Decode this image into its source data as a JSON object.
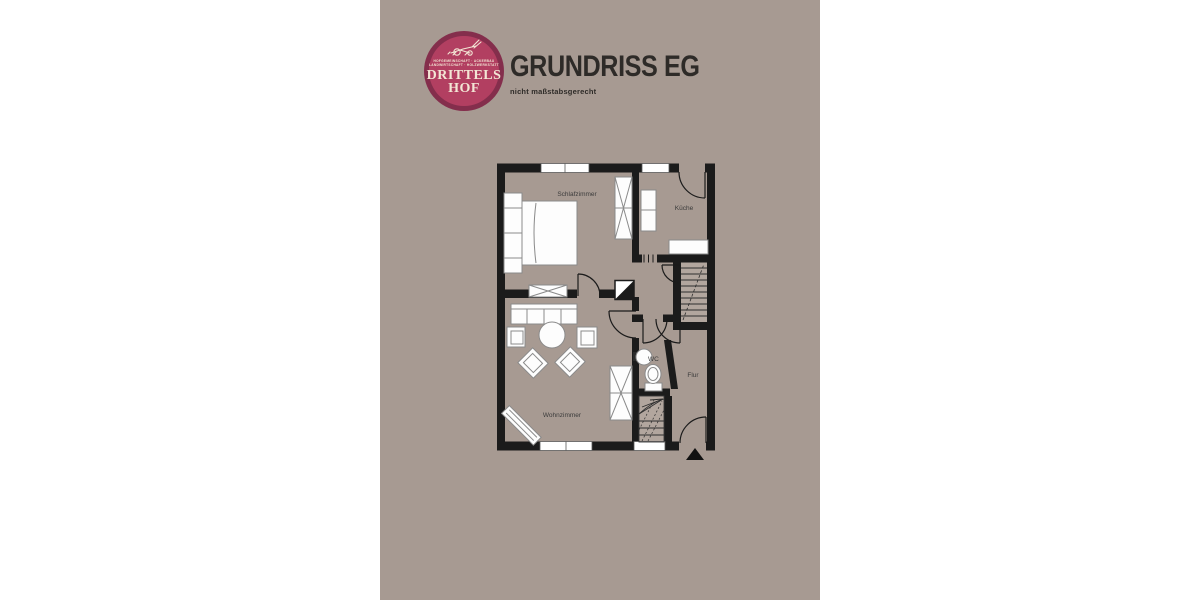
{
  "window": {
    "width": 1200,
    "height": 600
  },
  "colors": {
    "page_bg": "#ffffff",
    "panel_bg": "#a79a92",
    "wall": "#1b1b1b",
    "furniture_fill": "#fdfdfd",
    "furniture_stroke": "#8a8a8a",
    "stair_fill": "#b2a69e",
    "label": "#3b3b3b",
    "logo_ring": "#842e4c",
    "logo_face": "#b23f61",
    "logo_text": "#f3e6d5",
    "title": "#2e2b28"
  },
  "logo": {
    "title_line1": "DRITTELS",
    "title_line2": "HOF",
    "tagline_line1": "HOFGEMEINSCHAFT · ACKERBAU",
    "tagline_line2": "LANDWIRTSCHAFT · HOLZWERKSTATT",
    "illustration": "plow-illustration"
  },
  "header": {
    "title": "GRUNDRISS EG",
    "subtitle": "nicht maßstabsgerecht"
  },
  "floorplan": {
    "rooms": [
      {
        "id": "schlafzimmer",
        "label": "Schlafzimmer"
      },
      {
        "id": "kueche",
        "label": "Küche"
      },
      {
        "id": "wohnzimmer",
        "label": "Wohnzimmer"
      },
      {
        "id": "wc",
        "label": "WC"
      },
      {
        "id": "flur",
        "label": "Flur"
      }
    ]
  }
}
